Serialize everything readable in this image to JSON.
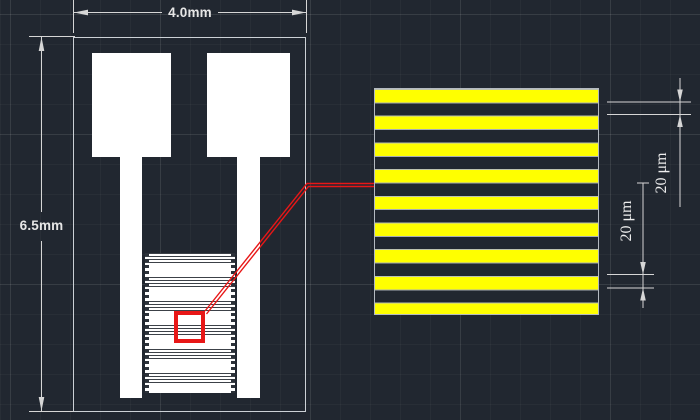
{
  "canvas": {
    "background_color": "#212730",
    "drawing_color": "#ffffff",
    "dimension_color": "#d6d6d6",
    "callout_color": "#e81717",
    "stripe_yellow": "#ffff00"
  },
  "chip": {
    "width_dimension": "4.0mm",
    "height_dimension": "6.5mm"
  },
  "detail_view": {
    "gap_dimension": "20 μm",
    "finger_dimension": "20 μm",
    "yellow_stripe_count": 9
  }
}
